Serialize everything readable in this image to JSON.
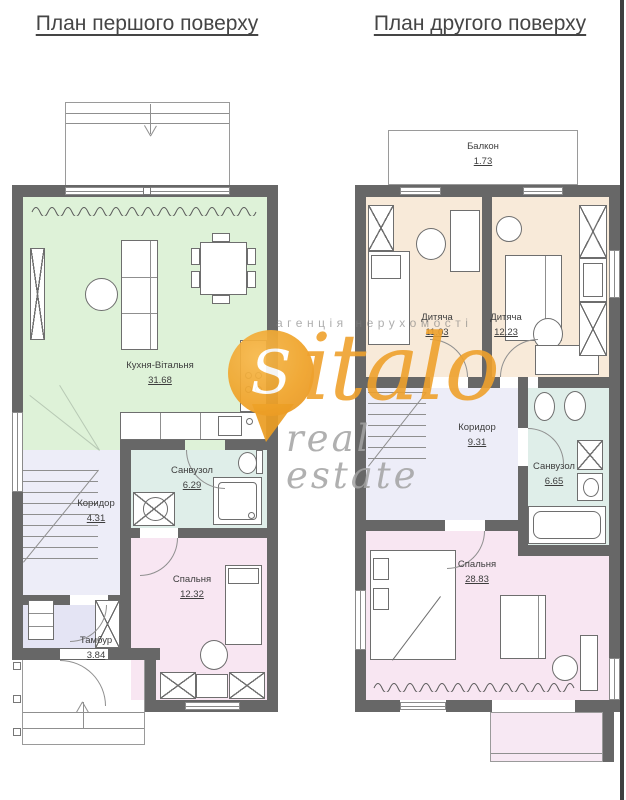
{
  "floor1": {
    "title": "План першого поверху",
    "rooms": [
      {
        "name": "Кухня-Вітальня",
        "area": "31.68"
      },
      {
        "name": "Санвузол",
        "area": "6.29"
      },
      {
        "name": "Коридор",
        "area": "4.31"
      },
      {
        "name": "Спальня",
        "area": "12.32"
      },
      {
        "name": "Тамбур",
        "area": "3.84"
      }
    ]
  },
  "floor2": {
    "title": "План другого поверху",
    "rooms": [
      {
        "name": "Балкон",
        "area": "1.73"
      },
      {
        "name": "Дитяча",
        "area": "11.03"
      },
      {
        "name": "Дитяча",
        "area": "12.23"
      },
      {
        "name": "Коридор",
        "area": "9.31"
      },
      {
        "name": "Санвузол",
        "area": "6.65"
      },
      {
        "name": "Спальня",
        "area": "28.83"
      }
    ]
  },
  "watermark": {
    "brand_initial": "S",
    "brand_rest": "italo",
    "tagline": "агенція нерухомості",
    "subtitle": "real estate"
  },
  "colors": {
    "wall": "#676767",
    "kitchen_living": "#def2d8",
    "children_room": "#f8ead9",
    "bathroom": "#dfeee9",
    "bedroom": "#f8e6f2",
    "corridor": "#ededf8",
    "tambour": "#e4e4f4",
    "balcony": "#f7e8f3",
    "watermark_orange": "#efa228",
    "watermark_gray": "#9e9e9e"
  }
}
